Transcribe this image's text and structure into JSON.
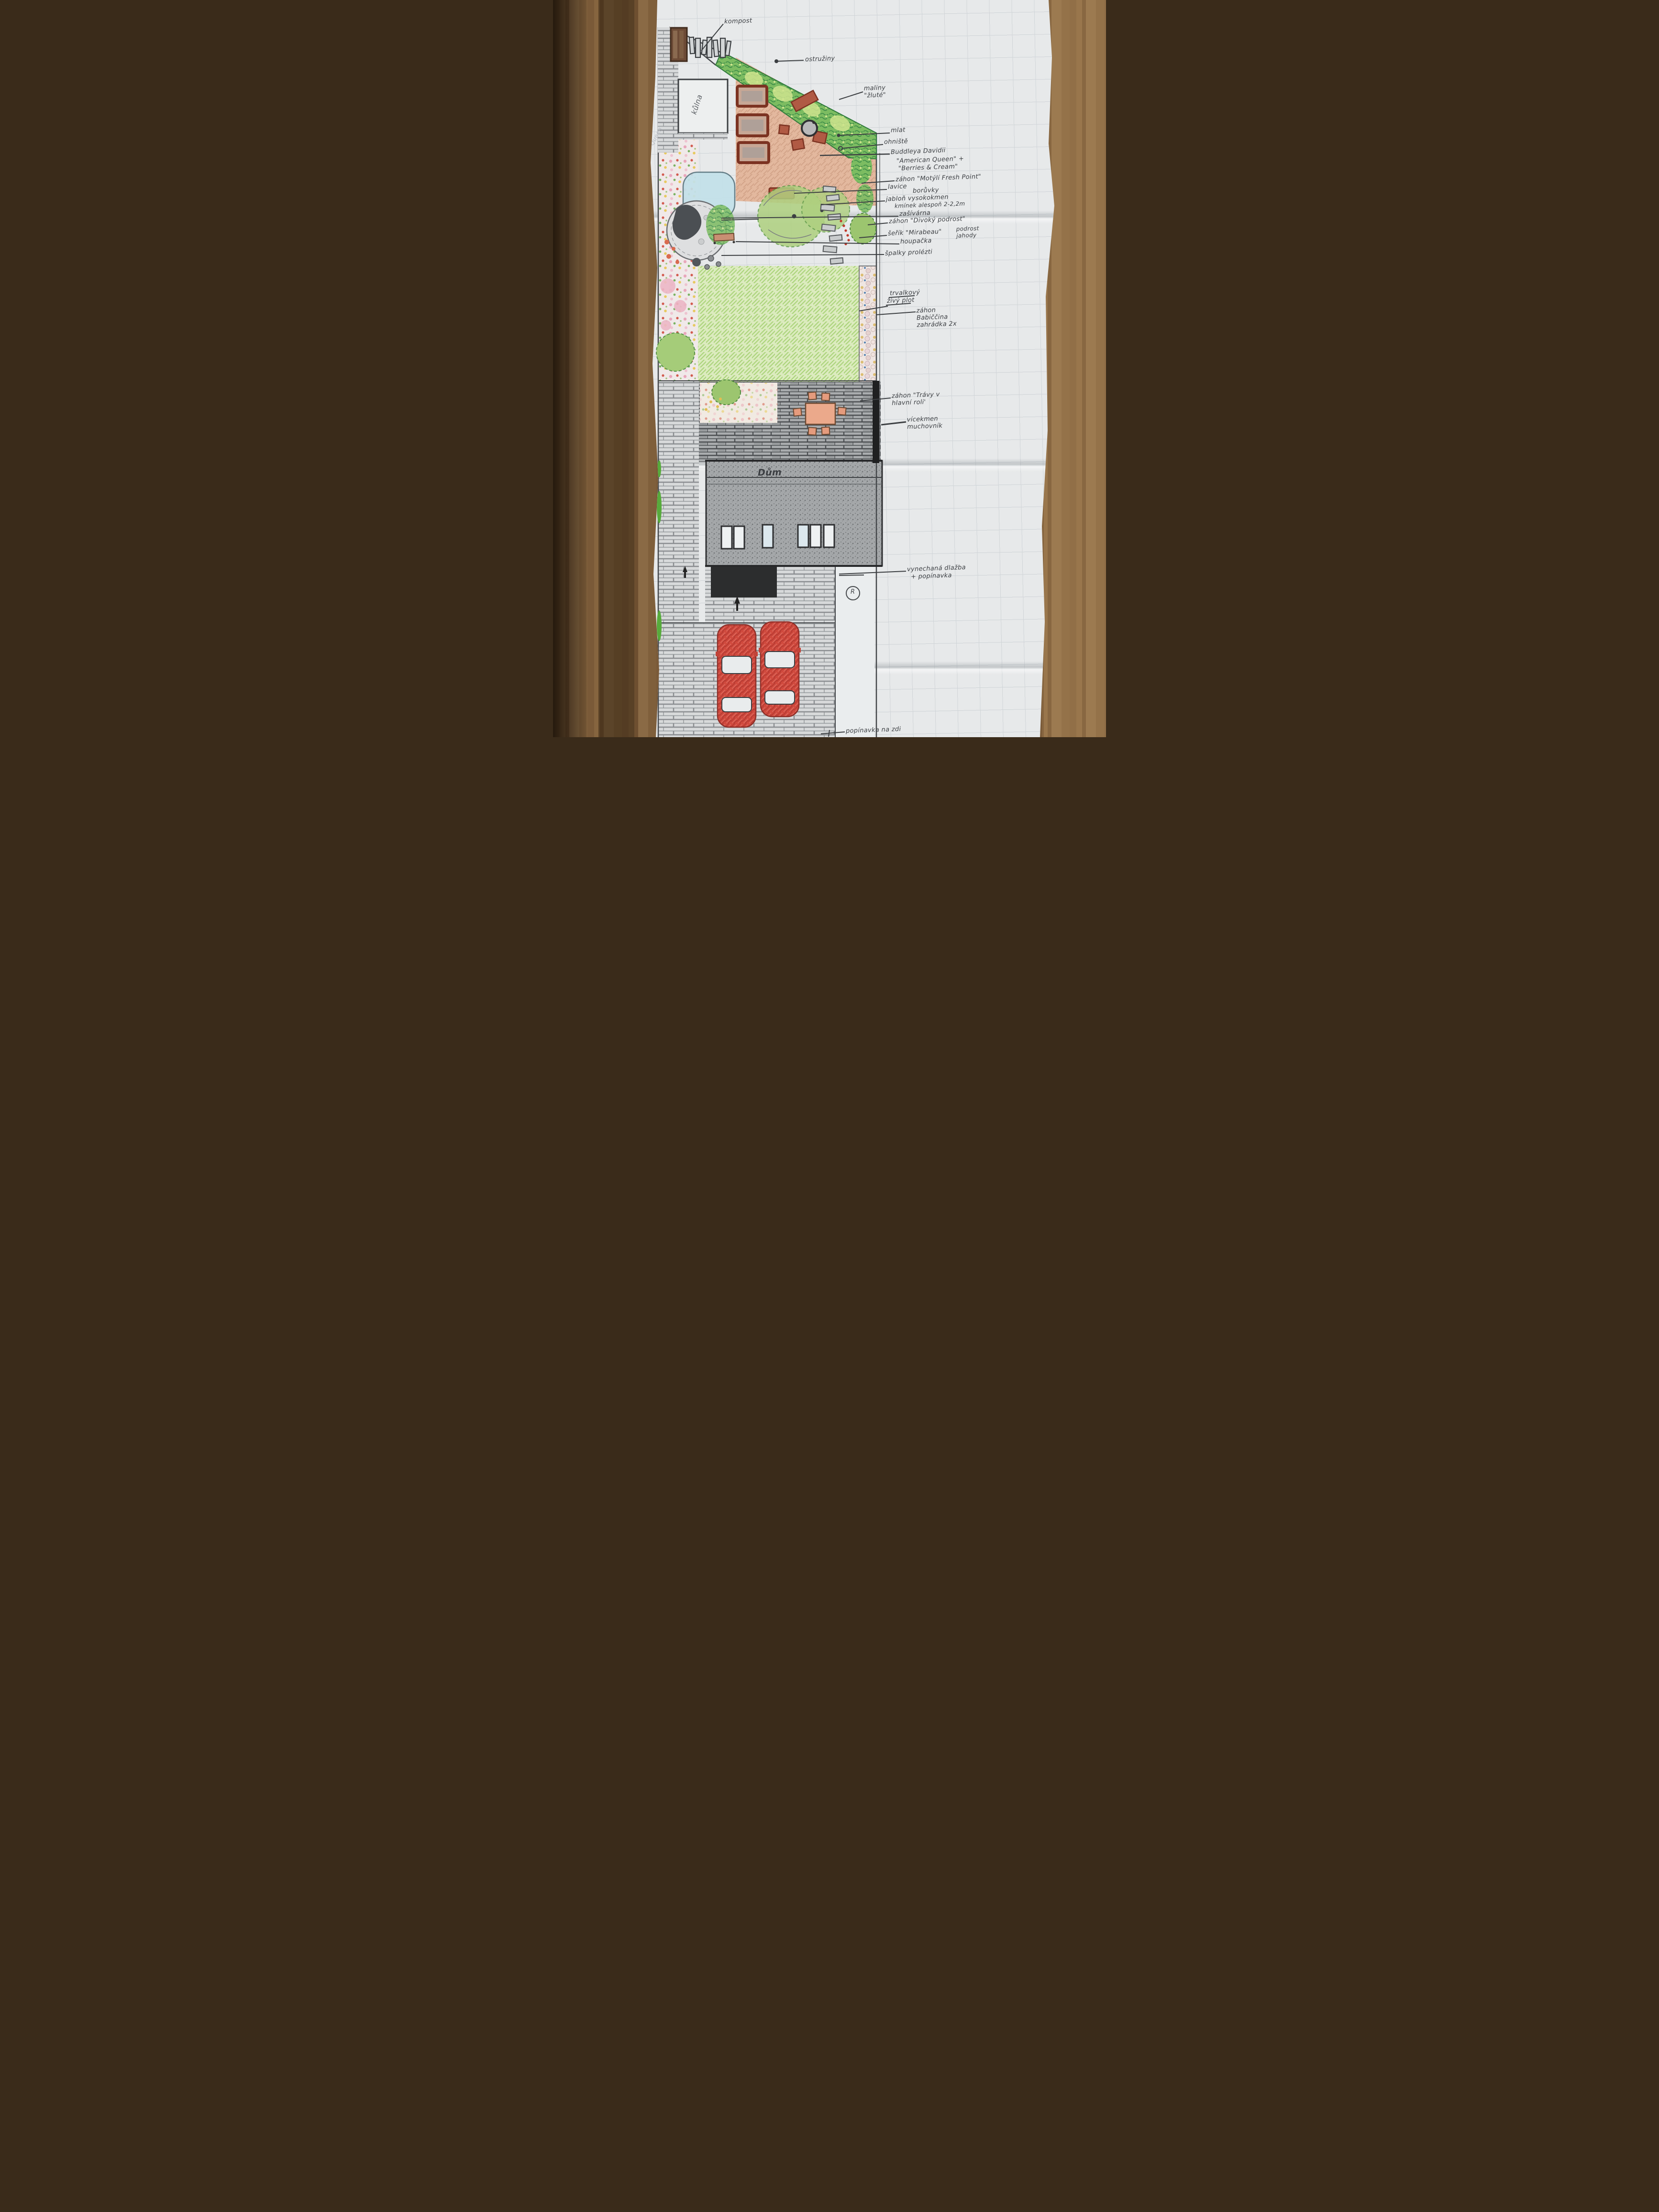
{
  "document": {
    "kind": "hand-drawn garden plan on squared paper, photographed on a wooden table"
  },
  "labels": [
    {
      "id": "kompost",
      "text": "kompost"
    },
    {
      "id": "ostruziny",
      "text": "ostružiny"
    },
    {
      "id": "maliny-zlute",
      "text": "maliny\n\"žluté\""
    },
    {
      "id": "mlat",
      "text": "mlat"
    },
    {
      "id": "ohniste",
      "text": "ohniště"
    },
    {
      "id": "buddleya",
      "text": "Buddleya Davidii"
    },
    {
      "id": "american-queen",
      "text": "\"American Queen\" +"
    },
    {
      "id": "berries-cream",
      "text": "\"Berries & Cream\""
    },
    {
      "id": "zahon-motyli",
      "text": "záhon \"Motýlí Fresh Point\""
    },
    {
      "id": "lavice",
      "text": "lavice"
    },
    {
      "id": "boruvky",
      "text": "borůvky"
    },
    {
      "id": "jablon",
      "text": "jabloň vysokokmen"
    },
    {
      "id": "kminek",
      "text": "kmínek alespoň 2-2,2m"
    },
    {
      "id": "zasivarna",
      "text": "zašívárna"
    },
    {
      "id": "zahon-divoky",
      "text": "záhon \"Divoký podrost\""
    },
    {
      "id": "serik-mirabeau",
      "text": "šeřík \"Mirabeau\""
    },
    {
      "id": "podrost-jahody",
      "text": "podrost\njahody"
    },
    {
      "id": "houpacka",
      "text": "houpačka"
    },
    {
      "id": "spalky",
      "text": "špalky prolézti"
    },
    {
      "id": "trvalkovy",
      "text": "trvalkový"
    },
    {
      "id": "zivy-plot",
      "text": "živý plot"
    },
    {
      "id": "zahon-babiccina",
      "text": "záhon\nBabiččina\nzahrádka 2x"
    },
    {
      "id": "zahon-travy",
      "text": "záhon \"Trávy v\nhlavní roli'"
    },
    {
      "id": "vicekmen",
      "text": "vícekmen\nmuchovník"
    },
    {
      "id": "dum",
      "text": "Dům"
    },
    {
      "id": "vynechana-dlazba",
      "text": "vynechaná dlažba"
    },
    {
      "id": "plus-popinavka",
      "text": "+ popínavka"
    },
    {
      "id": "popinavka-na-zdi",
      "text": "popínavka na zdi"
    },
    {
      "id": "kulna",
      "text": "kůlna"
    },
    {
      "id": "african-queen-note",
      "text": "African Queen"
    },
    {
      "id": "r-mark",
      "text": "R"
    }
  ],
  "colors": {
    "wood": "#8a6a45",
    "paper": "#e7e9ea",
    "grid_line": "#b9c0c5",
    "pencil": "#3c3f42",
    "raised_bed_red": "#7c3322",
    "mlat_terracotta": "#e2b295",
    "hedge_green": "#7cbc61",
    "lawn_green": "#dcebbf",
    "car_red": "#d0493d",
    "house_graphite": "#a4a7a9"
  }
}
